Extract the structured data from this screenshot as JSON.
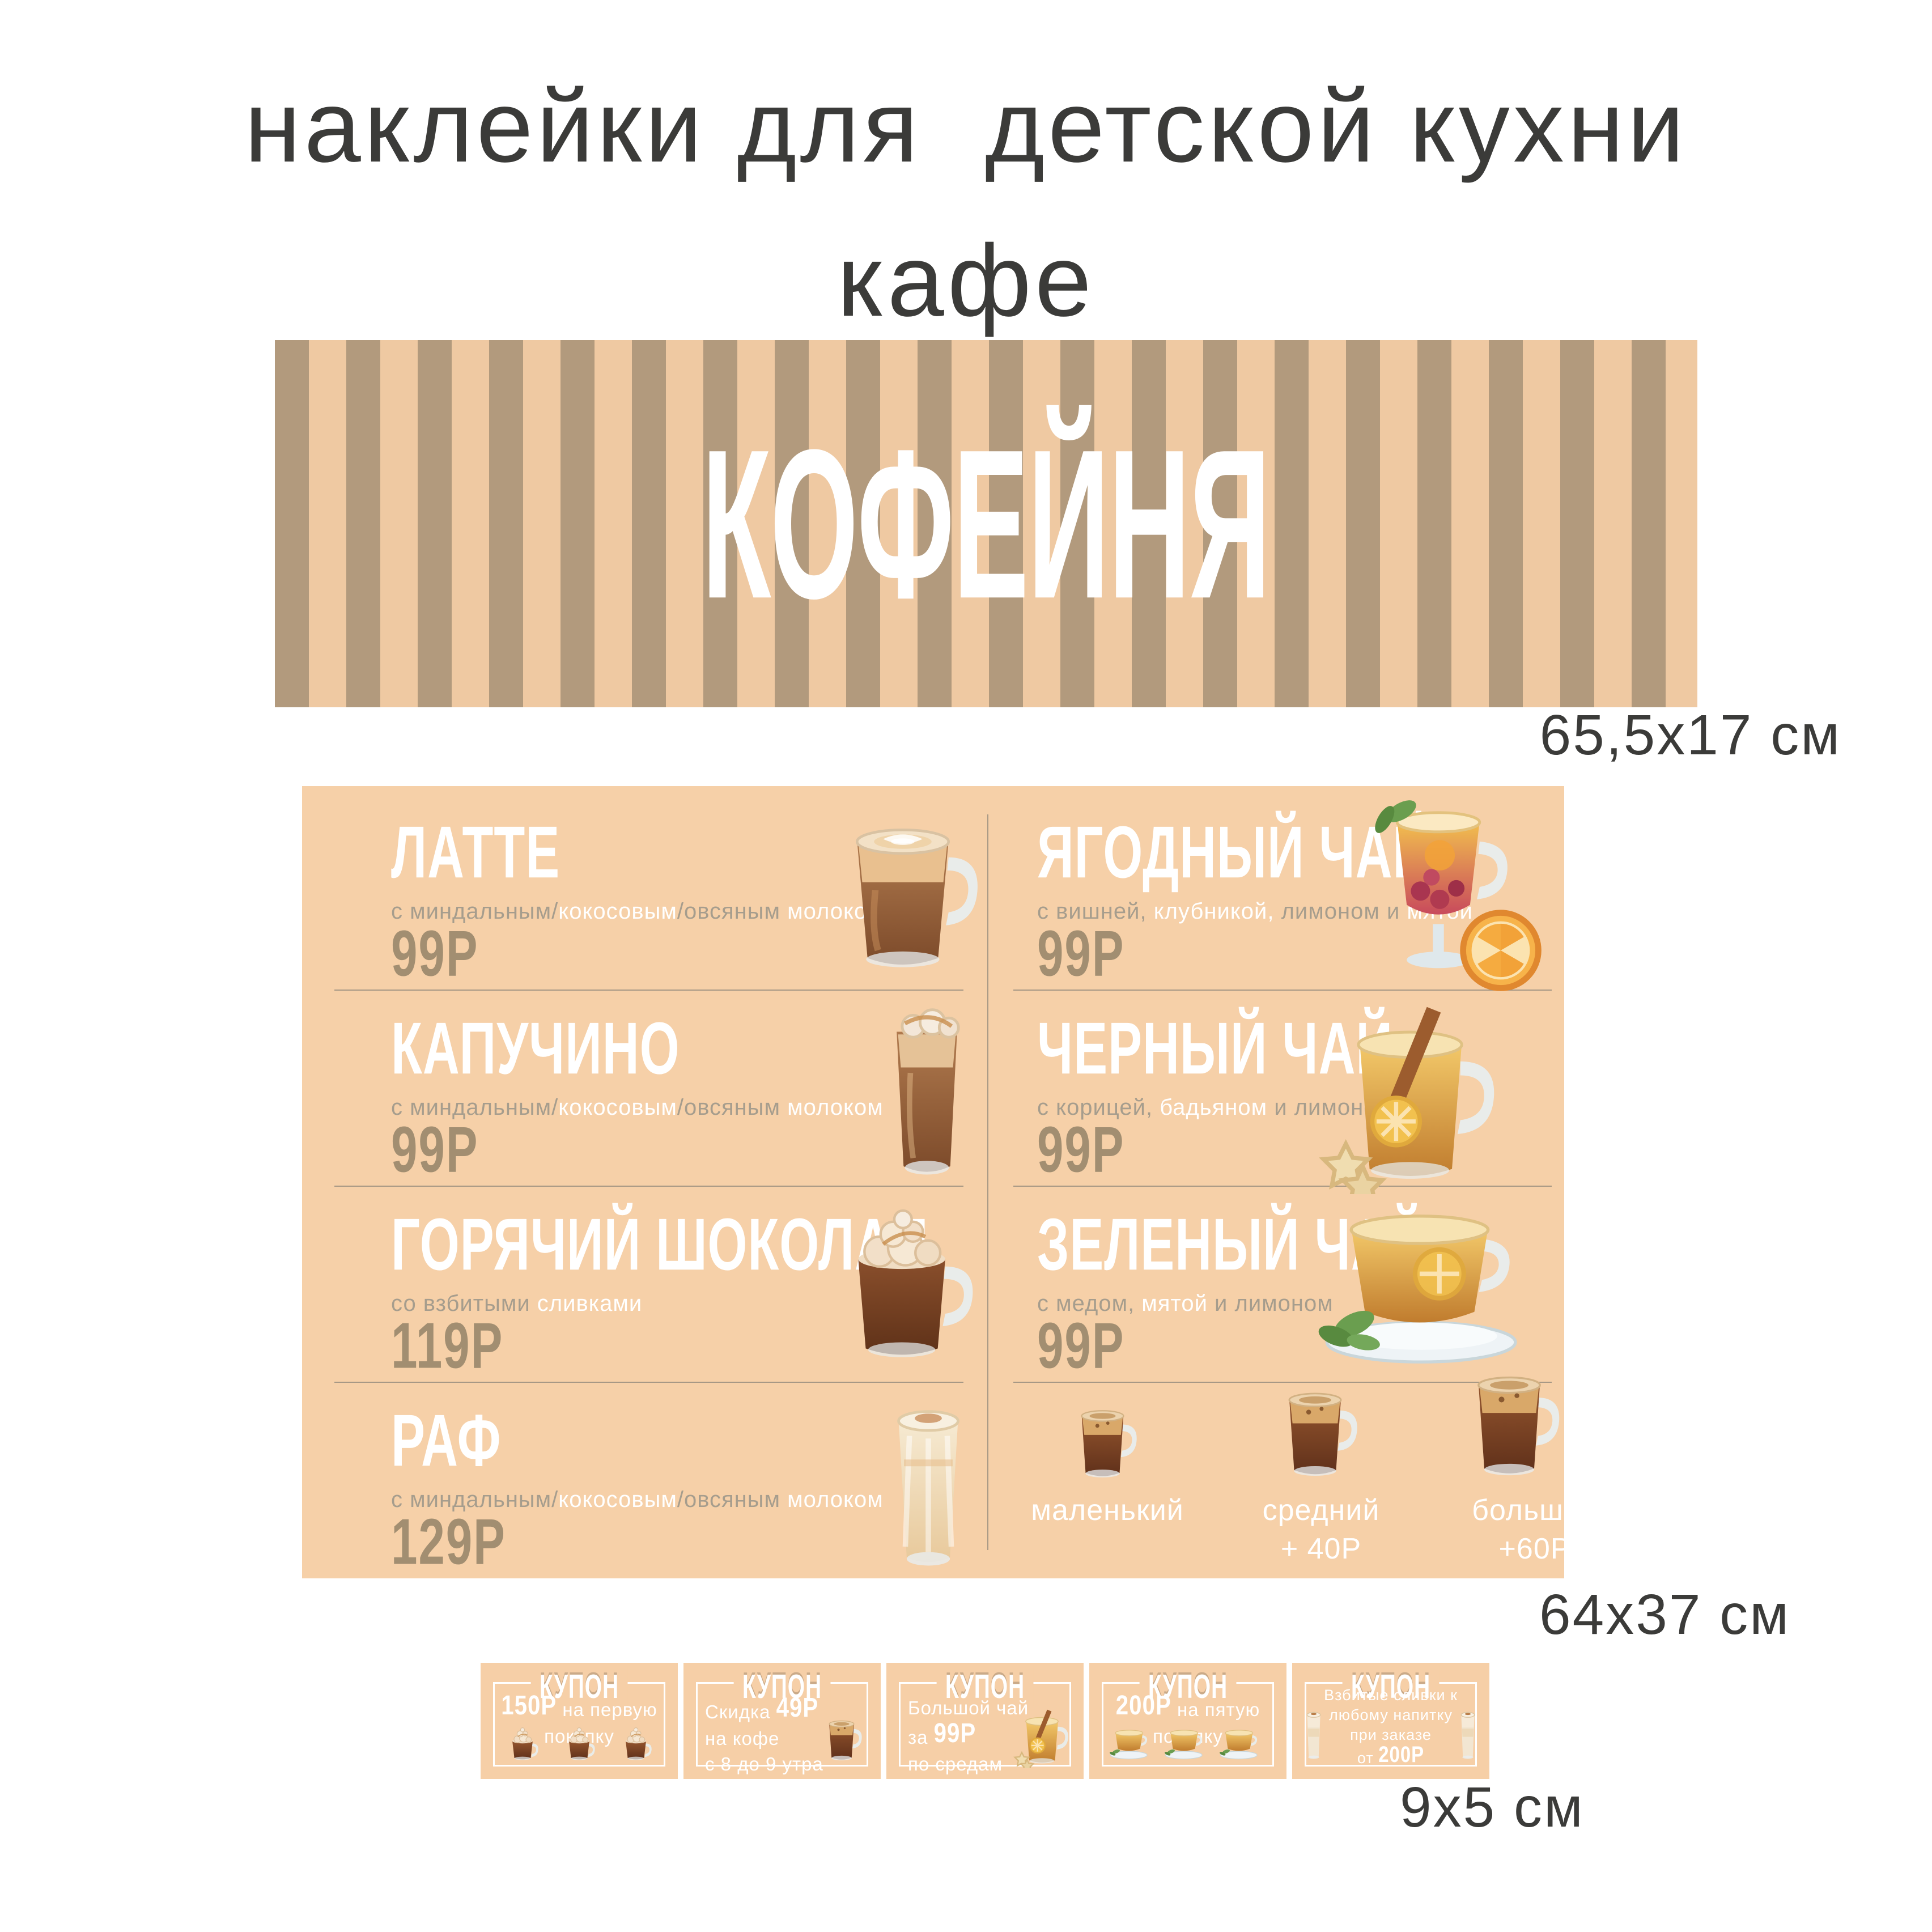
{
  "page": {
    "title_line1": "наклейки для  детской кухни",
    "title_line2": "кафе"
  },
  "banner": {
    "text": "КОФЕЙНЯ",
    "size_label": "65,5х17 см"
  },
  "menu": {
    "size_label": "64х37 см",
    "left_items": [
      {
        "name": "ЛАТТЕ",
        "price": "99Р",
        "image": "latte-glass",
        "desc": [
          {
            "t": "с миндальным/",
            "w": false
          },
          {
            "t": "кокосовым",
            "w": true
          },
          {
            "t": "/овсяным ",
            "w": false
          },
          {
            "t": "молоком",
            "w": true
          }
        ]
      },
      {
        "name": "КАПУЧИНО",
        "price": "99Р",
        "image": "cappuccino-glass",
        "desc": [
          {
            "t": "с миндальным/",
            "w": false
          },
          {
            "t": "кокосовым",
            "w": true
          },
          {
            "t": "/овсяным ",
            "w": false
          },
          {
            "t": "молоком",
            "w": true
          }
        ]
      },
      {
        "name": "ГОРЯЧИЙ ШОКОЛАД",
        "price": "119Р",
        "image": "hot-chocolate-mug",
        "desc": [
          {
            "t": "со взбитыми ",
            "w": false
          },
          {
            "t": "сливками",
            "w": true
          }
        ]
      },
      {
        "name": "РАФ",
        "price": "129Р",
        "image": "raf-glass",
        "desc": [
          {
            "t": "с миндальным/",
            "w": false
          },
          {
            "t": "кокосовым",
            "w": true
          },
          {
            "t": "/овсяным ",
            "w": false
          },
          {
            "t": "молоком",
            "w": true
          }
        ]
      }
    ],
    "right_items": [
      {
        "name": "ЯГОДНЫЙ ЧАЙ",
        "price": "99Р",
        "image": "berry-tea-glass",
        "desc": [
          {
            "t": "с вишней, ",
            "w": false
          },
          {
            "t": "клубникой, ",
            "w": true
          },
          {
            "t": "лимоном и ",
            "w": false
          },
          {
            "t": "мятой",
            "w": true
          }
        ]
      },
      {
        "name": "ЧЕРНЫЙ ЧАЙ",
        "price": "99Р",
        "image": "black-tea-glass",
        "desc": [
          {
            "t": "с корицей, ",
            "w": false
          },
          {
            "t": "бадьяном ",
            "w": true
          },
          {
            "t": "и лимоном",
            "w": false
          }
        ]
      },
      {
        "name": "ЗЕЛЕНЫЙ ЧАЙ",
        "price": "99Р",
        "image": "green-tea-cup",
        "desc": [
          {
            "t": "с медом, ",
            "w": false
          },
          {
            "t": "мятой ",
            "w": true
          },
          {
            "t": "и лимоном",
            "w": false
          }
        ]
      }
    ],
    "sizes": [
      {
        "label": "маленький",
        "surcharge": ""
      },
      {
        "label": "средний",
        "surcharge": "+ 40Р"
      },
      {
        "label": "большой",
        "surcharge": "+60Р"
      }
    ]
  },
  "coupons": {
    "size_label": "9х5 см",
    "items": [
      {
        "title": "КУПОН",
        "image": "three-cream-mugs",
        "lines": [
          [
            {
              "t": "150Р",
              "b": true
            },
            {
              "t": " на первую покупку",
              "b": false
            }
          ]
        ]
      },
      {
        "title": "КУПОН",
        "image": "coffee-glass",
        "lines": [
          [
            {
              "t": "Скидка ",
              "b": false
            },
            {
              "t": "49Р",
              "b": true
            },
            {
              "t": " на кофе",
              "b": false
            }
          ],
          [
            {
              "t": "с 8 до 9 утра",
              "b": false
            }
          ]
        ]
      },
      {
        "title": "КУПОН",
        "image": "tea-glass",
        "lines": [
          [
            {
              "t": "Большой чай за ",
              "b": false
            },
            {
              "t": "99Р",
              "b": true
            }
          ],
          [
            {
              "t": "по средам",
              "b": false
            }
          ]
        ]
      },
      {
        "title": "КУПОН",
        "image": "three-tea-cups",
        "lines": [
          [
            {
              "t": "200Р",
              "b": true
            },
            {
              "t": " на пятую покупку",
              "b": false
            }
          ]
        ]
      },
      {
        "title": "КУПОН",
        "image": "two-milkshake-glasses",
        "lines": [
          [
            {
              "t": "Взбитые сливки к",
              "b": false
            }
          ],
          [
            {
              "t": "любому напитку",
              "b": false
            }
          ],
          [
            {
              "t": "при заказе",
              "b": false
            }
          ],
          [
            {
              "t": "от ",
              "b": false
            },
            {
              "t": "200Р",
              "b": true
            }
          ]
        ]
      }
    ]
  },
  "colors": {
    "menu_bg": "#f6d0a8",
    "coupon_bg": "#f6cfa7",
    "stripe_dark": "#b29a7d",
    "stripe_light": "#efc9a2",
    "price": "#a28e71",
    "text_dark": "#3b3b39",
    "desc_gray": "#a69d8d",
    "divider": "#94897c",
    "accent_white": "#ffffff"
  }
}
